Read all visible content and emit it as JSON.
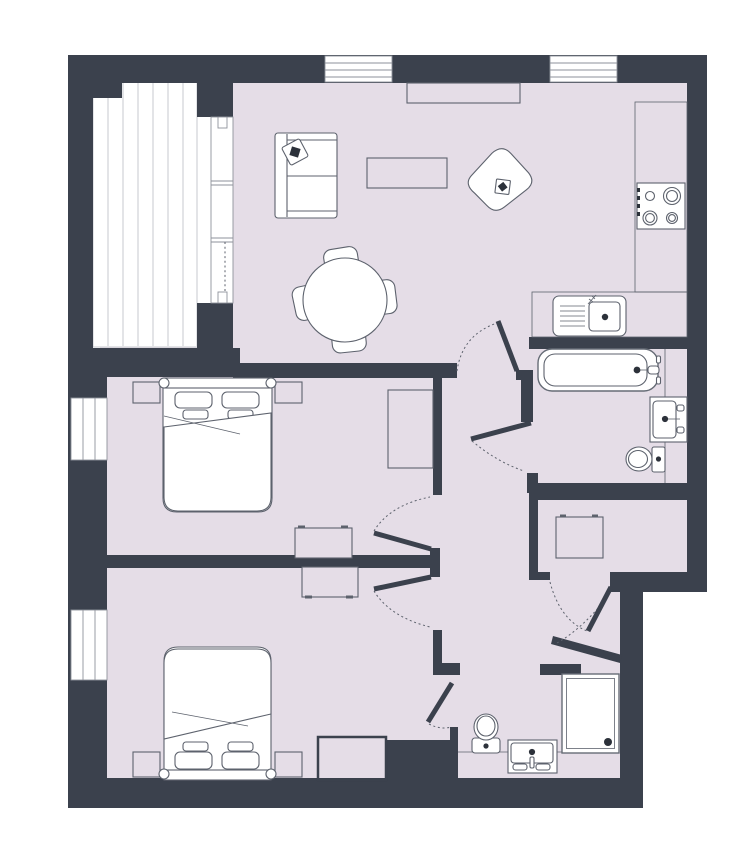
{
  "title": "Two-bedroom apartment floor plan",
  "colors": {
    "wall": "#3b414d",
    "floor": "#e5dde7",
    "outline": "#5d626d",
    "fixture": "#666c76",
    "winline": "#8e929b",
    "deckline": "#c7c9cf",
    "dark": "#2c313a"
  },
  "rooms": [
    {
      "id": "living-room",
      "name": "Living room",
      "fixtures": [
        "sofa",
        "throw-pillow",
        "coffee-table",
        "media-unit",
        "armchair",
        "dining-table",
        "dining-chairs"
      ]
    },
    {
      "id": "kitchen",
      "name": "Kitchen",
      "fixtures": [
        "counter",
        "hob",
        "sink-with-drainboard"
      ]
    },
    {
      "id": "bathroom-1",
      "name": "Bathroom",
      "fixtures": [
        "bathtub",
        "washbasin-vanity",
        "toilet"
      ]
    },
    {
      "id": "storage",
      "name": "Storage / utility room",
      "fixtures": [
        "appliance"
      ]
    },
    {
      "id": "bedroom-1",
      "name": "Bedroom 1",
      "fixtures": [
        "double-bed",
        "nightstand-left",
        "nightstand-right",
        "desk",
        "wardrobe"
      ]
    },
    {
      "id": "bedroom-2",
      "name": "Bedroom 2",
      "fixtures": [
        "double-bed",
        "nightstand-left",
        "nightstand-right",
        "desk",
        "built-in-closet"
      ]
    },
    {
      "id": "bathroom-2",
      "name": "Shower room",
      "fixtures": [
        "shower",
        "toilet",
        "washbasin-vanity"
      ]
    },
    {
      "id": "balcony",
      "name": "Balcony with decking",
      "fixtures": [
        "deck-boards",
        "glazed-sliding-door"
      ]
    },
    {
      "id": "hallway",
      "name": "Hallway",
      "fixtures": []
    }
  ],
  "doors": [
    {
      "id": "door-living-room",
      "name": "Living room door"
    },
    {
      "id": "door-bathroom-1",
      "name": "Bathroom door"
    },
    {
      "id": "door-bedroom-1",
      "name": "Bedroom 1 door"
    },
    {
      "id": "door-bedroom-2",
      "name": "Bedroom 2 door"
    },
    {
      "id": "door-bathroom-2",
      "name": "Shower room door"
    },
    {
      "id": "door-storage",
      "name": "Storage room door"
    },
    {
      "id": "door-balcony",
      "name": "Balcony sliding door"
    }
  ],
  "windows": [
    {
      "id": "window-top-left",
      "name": "Living room window left"
    },
    {
      "id": "window-top-right",
      "name": "Kitchen window"
    },
    {
      "id": "window-bedroom-1",
      "name": "Bedroom 1 window"
    },
    {
      "id": "window-bedroom-2",
      "name": "Bedroom 2 window"
    }
  ]
}
